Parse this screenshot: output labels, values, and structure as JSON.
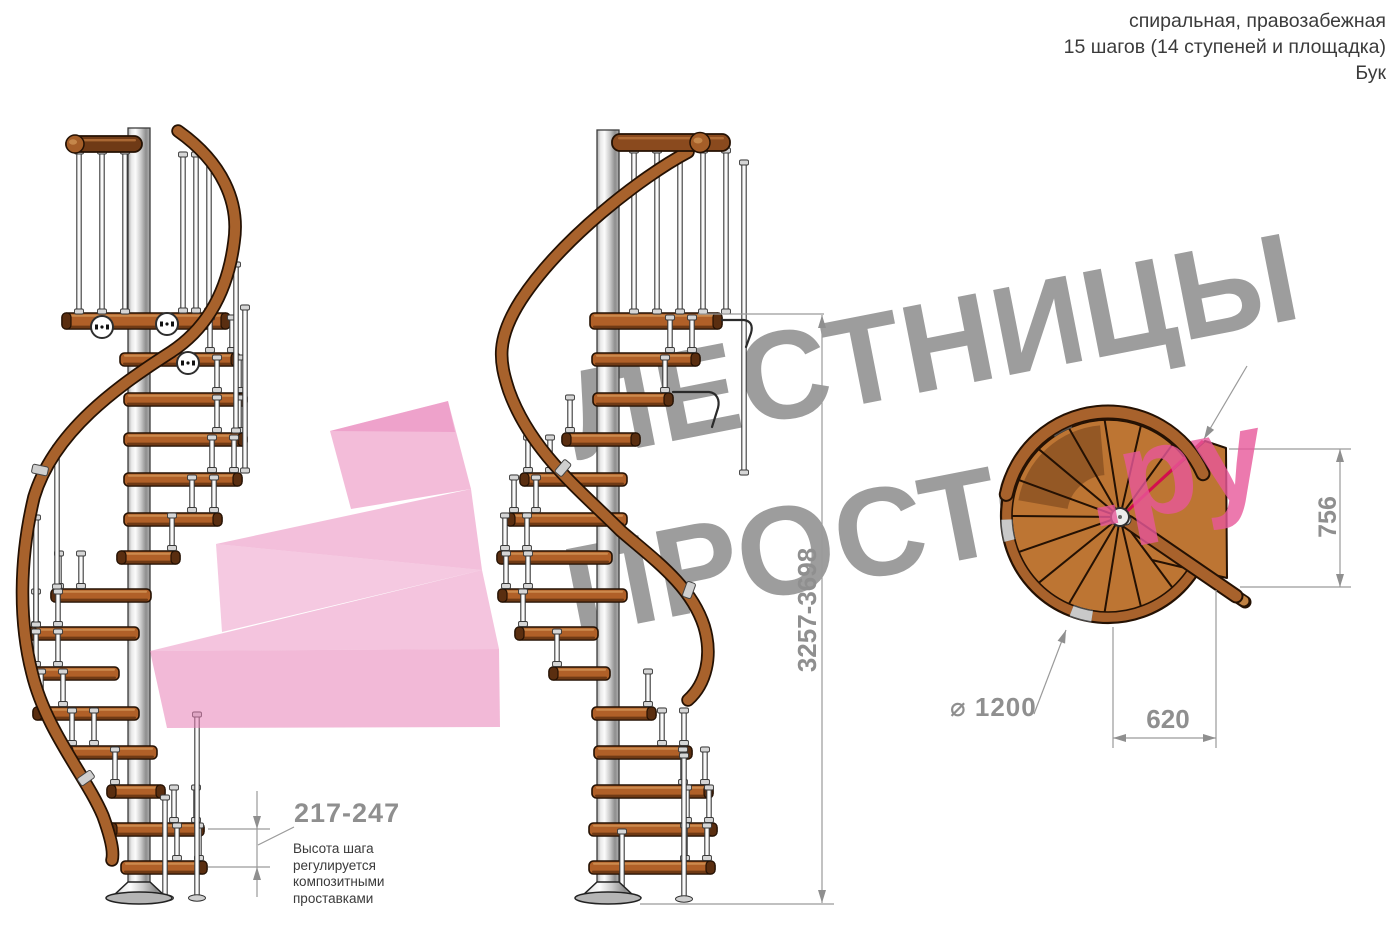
{
  "header": {
    "line1": "спиральная, правозабежная",
    "line2": "15 шагов (14 ступеней и площадка)",
    "line3": "Бук"
  },
  "watermark": {
    "line1": "ЛЕСТНИЦЫ",
    "line2": "ПРОСТО",
    "suffix": ".ру"
  },
  "dimensions": {
    "total_height": "3257-3698",
    "step_height": "217-247",
    "step_height_note": "Высота шага регулируется композитными проставками",
    "diameter": "⌀ 1200",
    "landing_width": "620",
    "landing_depth": "756"
  },
  "colors": {
    "wood": "#b06028",
    "wood_light": "#cf8f52",
    "wood_dark": "#5a2e10",
    "rail": "#a8622c",
    "outline": "#241103",
    "plan_wood": "#bd7533",
    "plan_rim": "#a8622c",
    "metal_light": "#fafafa",
    "metal_mid": "#b9b9b9",
    "watermark_gray": "#9d9d9d",
    "brand_pink": "#e8589a",
    "arrow_pink": "#e87fb7",
    "dim_gray": "#8f8f8f",
    "dim_line": "#9a9a9a",
    "note_text": "#3a3a3a",
    "accent_red": "#d40d4e"
  }
}
